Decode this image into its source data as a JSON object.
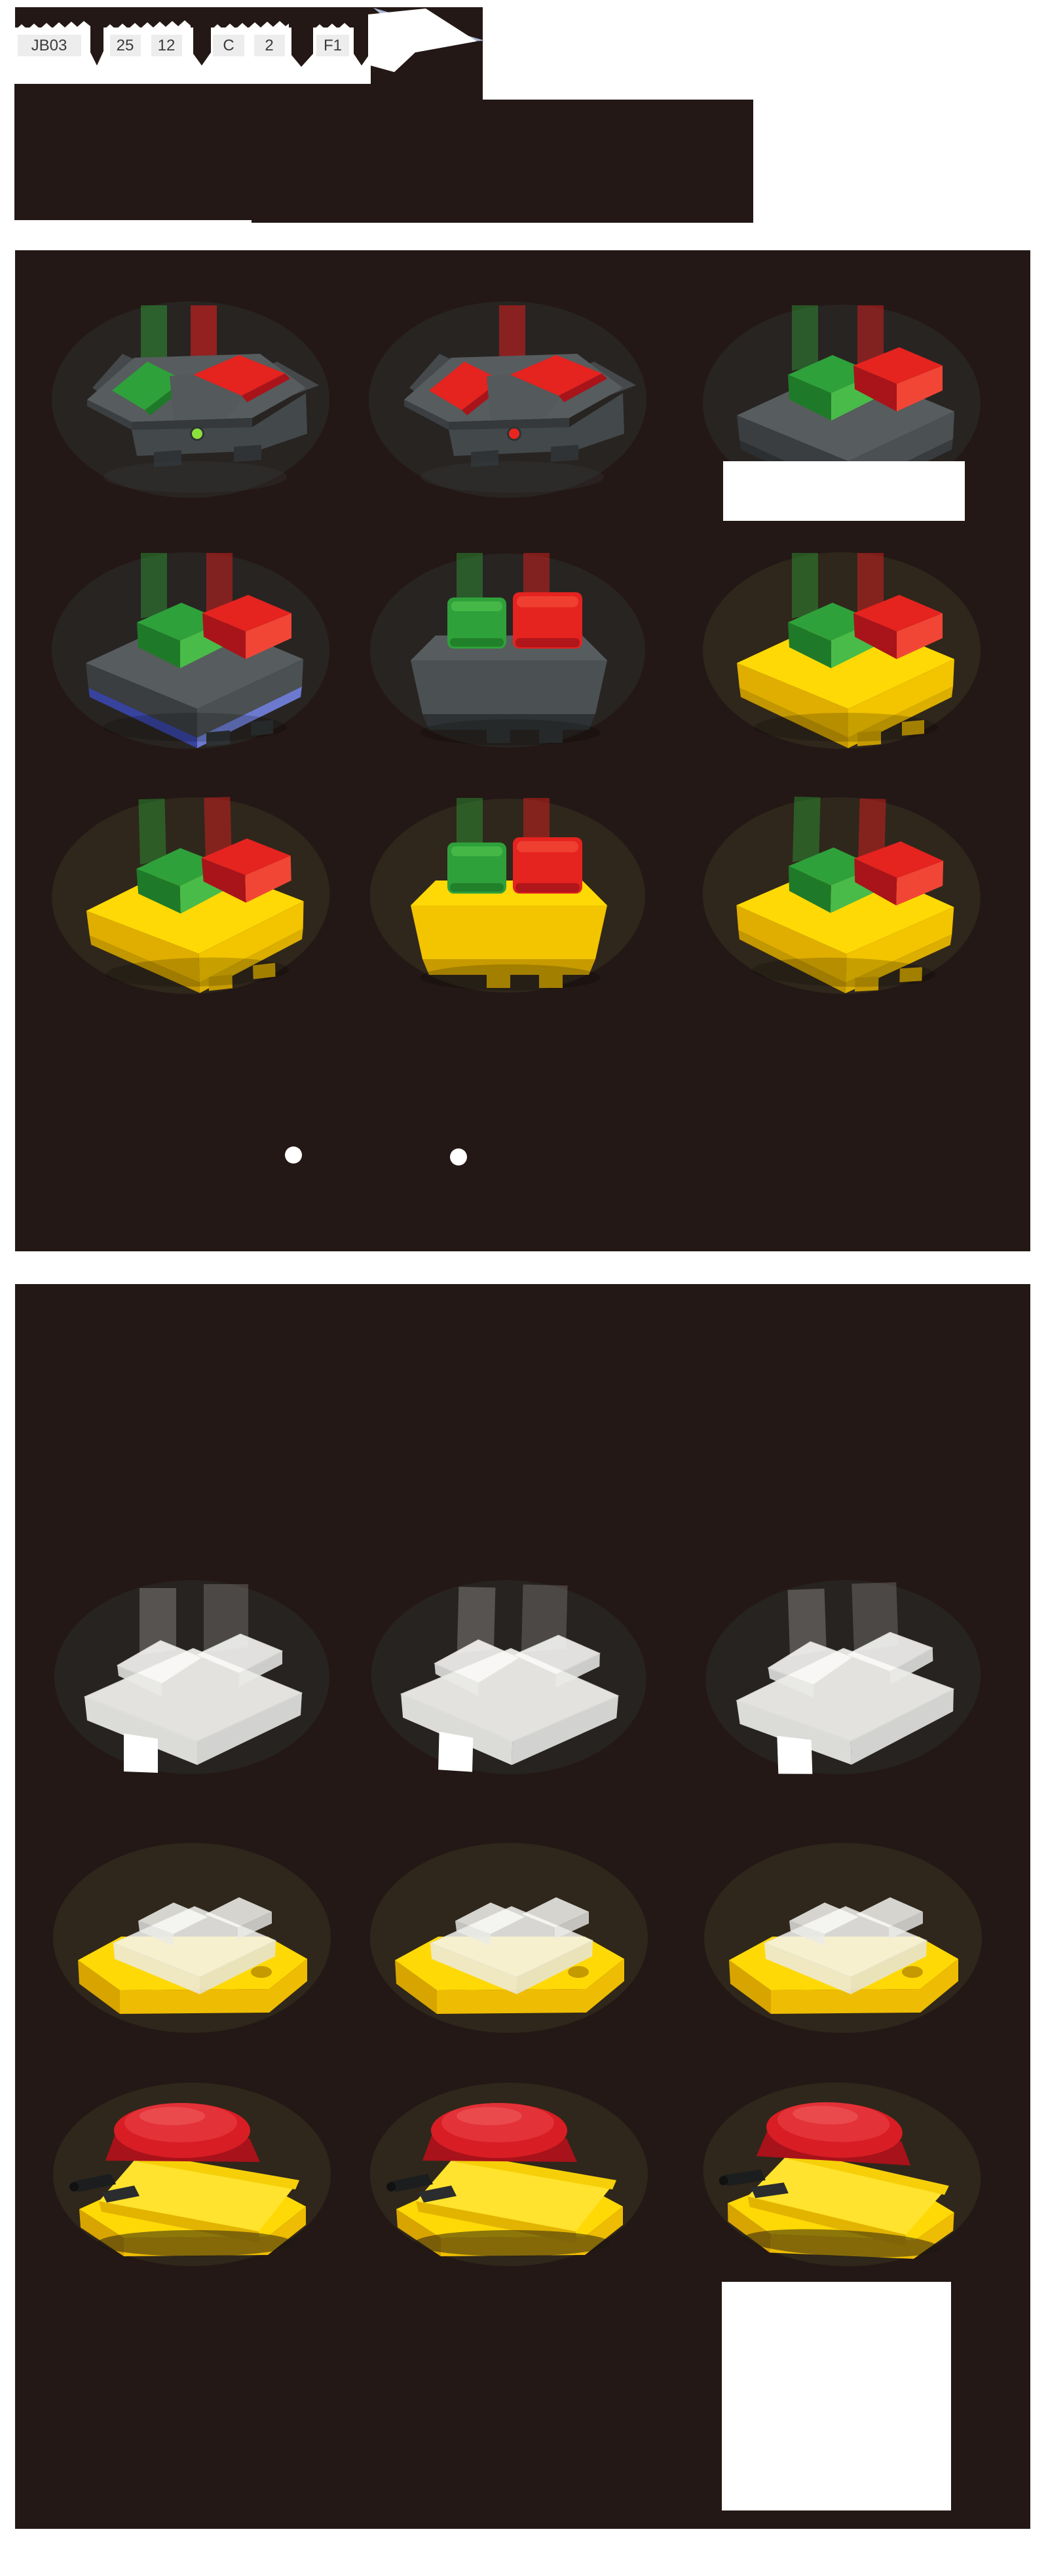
{
  "page": {
    "type": "product-catalog-page",
    "background": "#ffffff",
    "panel_background": "#231815"
  },
  "order_code": {
    "segments": [
      {
        "code": "JB03"
      },
      {
        "code": "25"
      },
      {
        "code": "12"
      },
      {
        "code": "C"
      },
      {
        "code": "2"
      },
      {
        "code": "F1"
      },
      {
        "code": "C3"
      }
    ]
  },
  "colors": {
    "panel_bg": "#231815",
    "yellow": "#ffd905",
    "red": "#e5231f",
    "green": "#2fa13b",
    "blue_band": "#5a6ac0",
    "clear_cover": "#f3f3f0",
    "fold_blue": "#a9b7d3",
    "code_box_bg": "#ededed",
    "led_green": "#8ce03c",
    "led_red": "#e8261f"
  },
  "panel1": {
    "products": [
      {
        "cell": "r1c1",
        "kind": "pedal",
        "pedals": [
          "green",
          "red"
        ],
        "led": "green"
      },
      {
        "cell": "r1c2",
        "kind": "pedal",
        "pedals": [
          "red",
          "red"
        ],
        "led": "red"
      },
      {
        "cell": "r1c3",
        "kind": "buttons-iso",
        "body": "dark",
        "buttons": [
          "green",
          "red"
        ]
      },
      {
        "cell": "r2c1",
        "kind": "buttons-iso",
        "body": "dark",
        "base_band": "blue",
        "buttons": [
          "green",
          "red"
        ]
      },
      {
        "cell": "r2c2",
        "kind": "buttons-front",
        "body": "dark",
        "buttons": [
          "green",
          "red"
        ]
      },
      {
        "cell": "r2c3",
        "kind": "buttons-iso",
        "body": "yellow",
        "buttons": [
          "green",
          "red"
        ]
      },
      {
        "cell": "r3c1",
        "kind": "buttons-iso",
        "body": "yellow",
        "buttons": [
          "green",
          "red"
        ]
      },
      {
        "cell": "r3c2",
        "kind": "buttons-front",
        "body": "yellow",
        "buttons": [
          "green",
          "red"
        ]
      },
      {
        "cell": "r3c3",
        "kind": "buttons-iso",
        "body": "yellow",
        "buttons": [
          "green",
          "red"
        ]
      }
    ]
  },
  "panel2": {
    "products": [
      {
        "cell": "r1c1",
        "kind": "cover",
        "body": "clear"
      },
      {
        "cell": "r1c2",
        "kind": "cover",
        "body": "clear"
      },
      {
        "cell": "r1c3",
        "kind": "cover",
        "body": "clear"
      },
      {
        "cell": "r2c1",
        "kind": "base-cover",
        "body": "yellow-clear"
      },
      {
        "cell": "r2c2",
        "kind": "base-cover",
        "body": "yellow-clear"
      },
      {
        "cell": "r2c3",
        "kind": "base-cover",
        "body": "yellow-clear"
      },
      {
        "cell": "r3c1",
        "kind": "estop-open",
        "body": "yellow",
        "button": "red"
      },
      {
        "cell": "r3c2",
        "kind": "estop-open",
        "body": "yellow",
        "button": "red"
      },
      {
        "cell": "r3c3",
        "kind": "estop-open",
        "body": "yellow",
        "button": "red"
      }
    ]
  },
  "bullet_dots": 2,
  "blank_label_boxes": 2
}
